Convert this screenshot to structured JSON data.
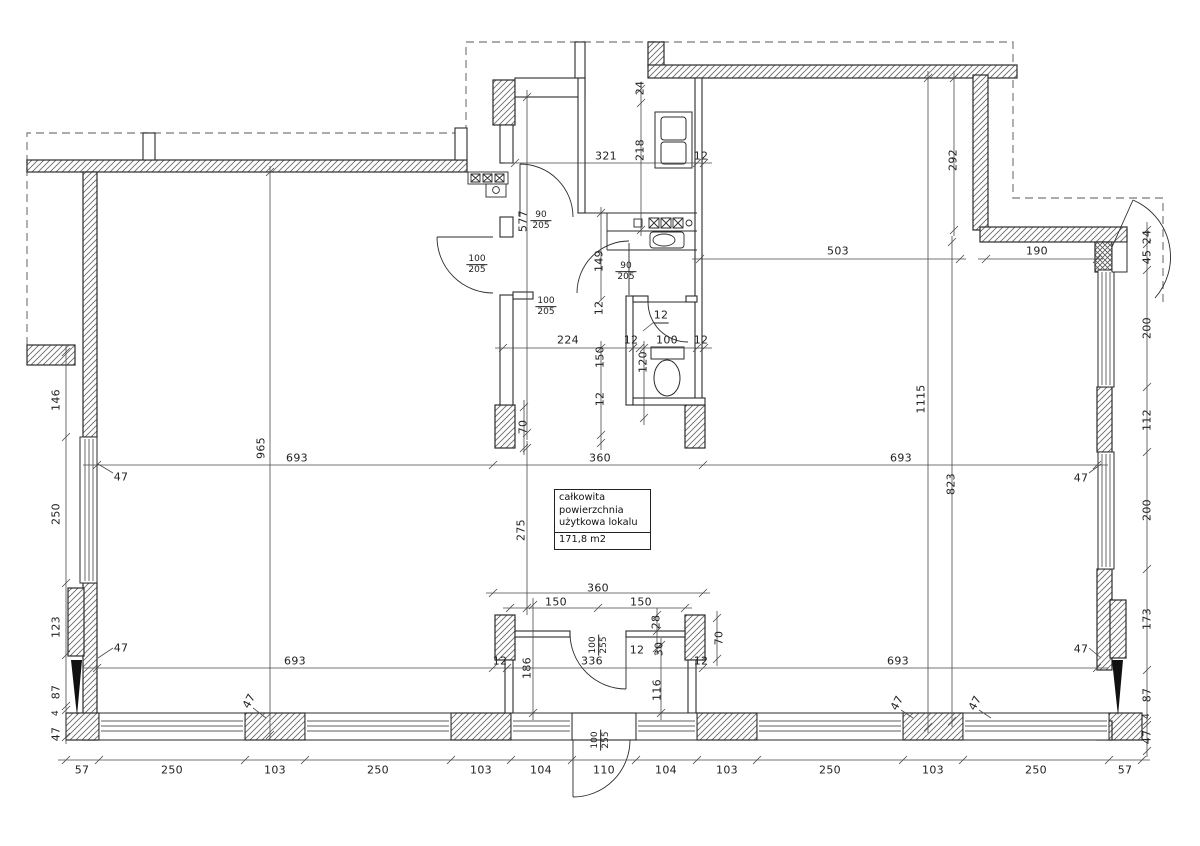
{
  "plan": {
    "area_box": {
      "line1": "całkowita powierzchnia",
      "line2": "użytkowa lokalu",
      "value": "171,8 m2"
    },
    "dimension_labels": [
      {
        "t": "321",
        "x": 606,
        "y": 156
      },
      {
        "t": "218",
        "x": 640,
        "y": 150,
        "r": "v"
      },
      {
        "t": "24",
        "x": 640,
        "y": 88,
        "r": "v"
      },
      {
        "t": "12",
        "x": 701,
        "y": 156
      },
      {
        "t": "292",
        "x": 953,
        "y": 160,
        "r": "v"
      },
      {
        "t": "503",
        "x": 838,
        "y": 251
      },
      {
        "t": "190",
        "x": 1037,
        "y": 251
      },
      {
        "t": "24",
        "x": 1147,
        "y": 237,
        "r": "v"
      },
      {
        "t": "45",
        "x": 1147,
        "y": 257,
        "r": "v"
      },
      {
        "t": "200",
        "x": 1147,
        "y": 328,
        "r": "v"
      },
      {
        "t": "112",
        "x": 1147,
        "y": 420,
        "r": "v"
      },
      {
        "t": "200",
        "x": 1147,
        "y": 510,
        "r": "v"
      },
      {
        "t": "173",
        "x": 1147,
        "y": 619,
        "r": "v"
      },
      {
        "t": "87",
        "x": 1147,
        "y": 695,
        "r": "v"
      },
      {
        "t": "4",
        "x": 1147,
        "y": 716,
        "r": "v",
        "fs": 9
      },
      {
        "t": "47",
        "x": 1147,
        "y": 737,
        "r": "v"
      },
      {
        "t": "1115",
        "x": 921,
        "y": 399,
        "r": "v"
      },
      {
        "t": "823",
        "x": 951,
        "y": 484,
        "r": "v"
      },
      {
        "t": "47",
        "x": 1081,
        "y": 478
      },
      {
        "t": "47",
        "x": 1081,
        "y": 649
      },
      {
        "t": "965",
        "x": 261,
        "y": 448,
        "r": "v"
      },
      {
        "t": "693",
        "x": 297,
        "y": 458
      },
      {
        "t": "360",
        "x": 600,
        "y": 458
      },
      {
        "t": "693",
        "x": 901,
        "y": 458
      },
      {
        "t": "70",
        "x": 523,
        "y": 427,
        "r": "v"
      },
      {
        "t": "146",
        "x": 56,
        "y": 400,
        "r": "v"
      },
      {
        "t": "250",
        "x": 56,
        "y": 514,
        "r": "v"
      },
      {
        "t": "123",
        "x": 56,
        "y": 627,
        "r": "v"
      },
      {
        "t": "87",
        "x": 56,
        "y": 692,
        "r": "v"
      },
      {
        "t": "4",
        "x": 56,
        "y": 713,
        "r": "v",
        "fs": 9
      },
      {
        "t": "47",
        "x": 56,
        "y": 734,
        "r": "v"
      },
      {
        "t": "47",
        "x": 121,
        "y": 477
      },
      {
        "t": "47",
        "x": 121,
        "y": 648
      },
      {
        "t": "577",
        "x": 523,
        "y": 221,
        "r": "v"
      },
      {
        "f": {
          "t": "90",
          "b": "205"
        },
        "x": 541,
        "y": 221
      },
      {
        "f": {
          "t": "100",
          "b": "205"
        },
        "x": 477,
        "y": 265
      },
      {
        "f": {
          "t": "100",
          "b": "205"
        },
        "x": 546,
        "y": 307
      },
      {
        "f": {
          "t": "90",
          "b": "205"
        },
        "x": 626,
        "y": 272
      },
      {
        "t": "149",
        "x": 599,
        "y": 261,
        "r": "v"
      },
      {
        "t": "224",
        "x": 568,
        "y": 340
      },
      {
        "t": "12",
        "x": 631,
        "y": 340
      },
      {
        "t": "100",
        "x": 667,
        "y": 340
      },
      {
        "t": "12",
        "x": 701,
        "y": 340
      },
      {
        "t": "12",
        "x": 661,
        "y": 316,
        "u": true
      },
      {
        "t": "12",
        "x": 599,
        "y": 308,
        "r": "v"
      },
      {
        "t": "150",
        "x": 600,
        "y": 357,
        "r": "v"
      },
      {
        "t": "120",
        "x": 643,
        "y": 362,
        "r": "v"
      },
      {
        "t": "12",
        "x": 600,
        "y": 399,
        "r": "v"
      },
      {
        "t": "275",
        "x": 521,
        "y": 530,
        "r": "v"
      },
      {
        "t": "360",
        "x": 598,
        "y": 588
      },
      {
        "t": "150",
        "x": 556,
        "y": 602
      },
      {
        "t": "150",
        "x": 641,
        "y": 602
      },
      {
        "t": "28",
        "x": 656,
        "y": 622,
        "r": "v"
      },
      {
        "t": "30",
        "x": 659,
        "y": 649,
        "r": "v"
      },
      {
        "t": "70",
        "x": 719,
        "y": 638,
        "r": "v"
      },
      {
        "t": "12",
        "x": 500,
        "y": 661
      },
      {
        "t": "186",
        "x": 527,
        "y": 668,
        "r": "v"
      },
      {
        "t": "336",
        "x": 592,
        "y": 661
      },
      {
        "t": "12",
        "x": 637,
        "y": 650
      },
      {
        "t": "116",
        "x": 657,
        "y": 690,
        "r": "v"
      },
      {
        "t": "12",
        "x": 701,
        "y": 661
      },
      {
        "t": "693",
        "x": 295,
        "y": 661
      },
      {
        "t": "693",
        "x": 898,
        "y": 661
      },
      {
        "f": {
          "t": "100",
          "b": "255"
        },
        "x": 599,
        "y": 645,
        "r": "v"
      },
      {
        "f": {
          "t": "100",
          "b": "255"
        },
        "x": 601,
        "y": 740,
        "r": "v"
      },
      {
        "t": "47",
        "x": 249,
        "y": 701,
        "r": "d"
      },
      {
        "t": "47",
        "x": 897,
        "y": 703,
        "r": "d"
      },
      {
        "t": "47",
        "x": 975,
        "y": 703,
        "r": "d"
      },
      {
        "t": "57",
        "x": 82,
        "y": 770
      },
      {
        "t": "250",
        "x": 172,
        "y": 770
      },
      {
        "t": "103",
        "x": 275,
        "y": 770
      },
      {
        "t": "250",
        "x": 378,
        "y": 770
      },
      {
        "t": "103",
        "x": 481,
        "y": 770
      },
      {
        "t": "104",
        "x": 541,
        "y": 770
      },
      {
        "t": "110",
        "x": 604,
        "y": 770
      },
      {
        "t": "104",
        "x": 666,
        "y": 770
      },
      {
        "t": "103",
        "x": 727,
        "y": 770
      },
      {
        "t": "250",
        "x": 830,
        "y": 770
      },
      {
        "t": "103",
        "x": 933,
        "y": 770
      },
      {
        "t": "250",
        "x": 1036,
        "y": 770
      },
      {
        "t": "57",
        "x": 1125,
        "y": 770
      }
    ]
  },
  "colors": {
    "line": "#2b2b2b",
    "dim_line": "#4a4a4a",
    "dashed": "#8f8f8f",
    "hatch": "#6b6b6b",
    "background": "#ffffff"
  }
}
